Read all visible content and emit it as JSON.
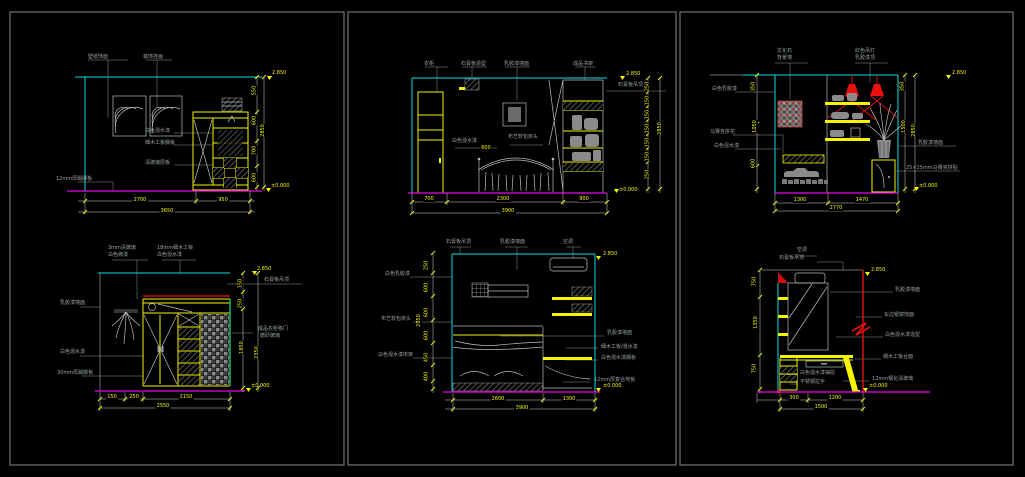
{
  "colors": {
    "background": "#000000",
    "ceiling_line": "#00dede",
    "furniture_line": "#f5f500",
    "floor_line": "#e800e8",
    "accent_red": "#e81010",
    "annotation_gray": "#98a2a2",
    "frame_gray": "#8a8a8a"
  },
  "panels": {
    "p1": {
      "top_labels": [
        "壁纸饰面",
        "装饰挂画"
      ],
      "mid_labels": [
        "白色混水漆",
        "细木工板搁板",
        "清玻璃层板"
      ],
      "side_label": "12mm厚踢脚板",
      "dims_bottom": [
        "2700",
        "950",
        "3650"
      ],
      "dims_right": [
        "550",
        "600",
        "700",
        "600"
      ],
      "dim_total": "2850",
      "level_top": "2.850",
      "level_bottom": "±0.000"
    },
    "p2": {
      "top_labels": [
        "衣柜",
        "石膏板造型",
        "乳胶漆墙面",
        "成品书架"
      ],
      "mid_labels": [
        "白色混水漆",
        "布艺软包床头"
      ],
      "inline_dim": "600",
      "right_label": "石膏板吊顶",
      "dims_bottom": [
        "700",
        "2300",
        "900",
        "3900"
      ],
      "dims_right": [
        "250",
        "150",
        "150",
        "150",
        "150",
        "150",
        "250"
      ],
      "dim_total": "2850",
      "level_top": "2.850",
      "level_bottom": "±0.000"
    },
    "p3": {
      "top_labels": [
        "文化石",
        "背景墙",
        "红色吊灯",
        "乳胶漆顶"
      ],
      "left_labels": [
        "白色乳胶漆",
        "马赛克拼花",
        "白色混水漆"
      ],
      "right_labels": [
        "乳胶漆墙面",
        "25×25mm马赛克拼贴"
      ],
      "dims_left": [
        "350",
        "1050",
        "600"
      ],
      "dims_right": [
        "350",
        "1500"
      ],
      "dim_total": "2850",
      "dims_bottom": [
        "1300",
        "1470",
        "2770"
      ],
      "level_top": "2.850",
      "level_bottom": "±0.000"
    },
    "p4": {
      "top_labels": [
        "3mm清玻璃",
        "白色烤漆",
        "18mm细木工板",
        "白色混水漆"
      ],
      "ceiling_label": "石膏板吊顶",
      "left_labels": [
        "乳胶漆墙面",
        "白色混水漆",
        "30mm厚踢脚板"
      ],
      "right_labels": [
        "成品衣柜移门",
        "磨砂玻璃"
      ],
      "dims_right": [
        "150",
        "250",
        "1850"
      ],
      "dim_total": "2350",
      "dims_bottom": [
        "150",
        "250",
        "2150",
        "2550"
      ],
      "level_top": "2.850",
      "level_bottom": "±0.000"
    },
    "p5": {
      "top_labels": [
        "石膏板吊顶",
        "乳胶漆墙面",
        "空调"
      ],
      "left_labels": [
        "白色乳胶漆",
        "布艺软包床头",
        "白色混水漆床架"
      ],
      "right_labels": [
        "乳胶漆墙面",
        "细木工板/混水漆",
        "白色混水漆搁板",
        "12mm厚复合地板"
      ],
      "dims_left": [
        "250",
        "600",
        "600",
        "600",
        "450",
        "400"
      ],
      "dim_total": "2850",
      "dims_bottom": [
        "2600",
        "1300",
        "3900"
      ],
      "level_top": "2.850",
      "level_bottom": "±0.000"
    },
    "p6": {
      "top_labels": [
        "空调",
        "石膏板吊顶"
      ],
      "inner_labels": [
        "白色混水漆抽屉",
        "不锈钢拉手"
      ],
      "right_labels": [
        "乳胶漆墙面",
        "车边银镜饰面",
        "白色混水漆造型",
        "细木工板台面",
        "12mm钢化清玻璃"
      ],
      "dims_left": [
        "750",
        "1350",
        "750"
      ],
      "dims_bottom": [
        "300",
        "1200",
        "1500"
      ],
      "level_top": "2.850",
      "level_bottom": "±0.000"
    }
  }
}
